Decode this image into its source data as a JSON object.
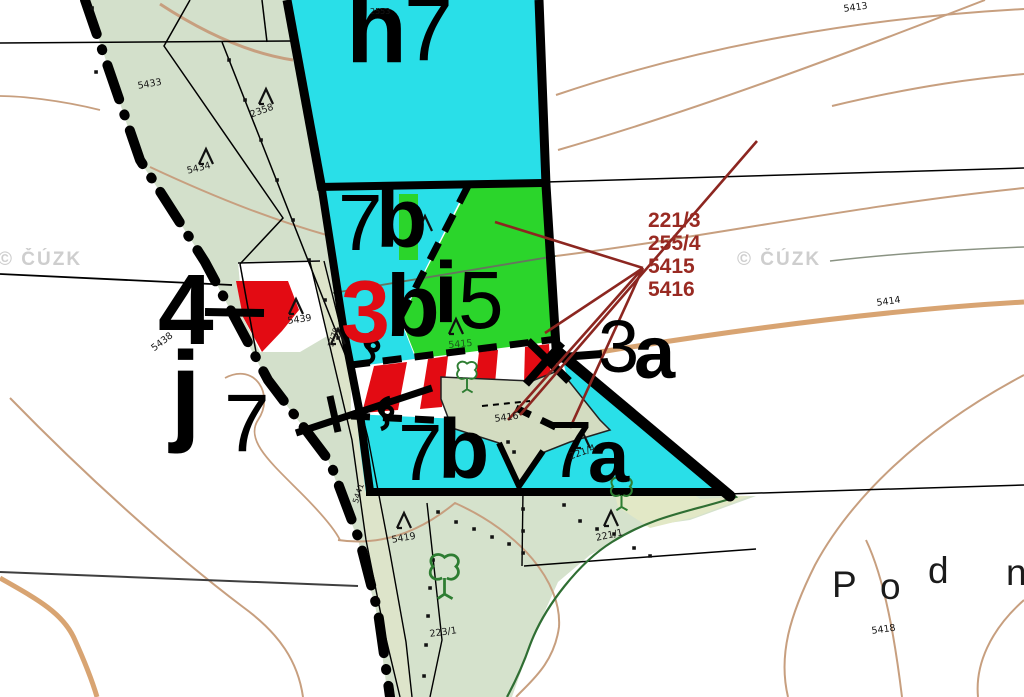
{
  "meta": {
    "width": 1024,
    "height": 697,
    "description": "Cadastral / forestry map detail with parcels, forest stand labels and contour lines"
  },
  "colors": {
    "cyan_parcel": "#29dfe8",
    "green_parcel": "#2bd52b",
    "red_parcel": "#e30b13",
    "sage_area": "#d3e0cb",
    "sage_bottom": "#d5e2cc",
    "sage_yellow": "#e2e8c6",
    "pentagon": "#d3dcc1",
    "strip": "#dde4ca",
    "contour_thin": "#c79f7f",
    "contour_thick": "#d8a472",
    "annotation_red": "#992a22",
    "leader_dark_red": "#8c2620",
    "boundary_black": "#000000",
    "forest_green_line": "#2f6e33",
    "watermark_gray": "#c6c6c6"
  },
  "watermarks": {
    "left": "© ČÚZK",
    "right": "© ČÚZK"
  },
  "place_name": {
    "chars": [
      "P",
      "o",
      "d",
      "n"
    ]
  },
  "stand_labels": [
    {
      "t": "h"
    },
    {
      "t": "7"
    },
    {
      "t": "7"
    },
    {
      "t": "b"
    },
    {
      "t": "3"
    },
    {
      "t": "b"
    },
    {
      "t": "i"
    },
    {
      "t": "5"
    },
    {
      "t": "3"
    },
    {
      "t": "a"
    },
    {
      "t": "7"
    },
    {
      "t": "b"
    },
    {
      "t": "7"
    },
    {
      "t": "a"
    },
    {
      "t": "4"
    },
    {
      "t": "j"
    },
    {
      "t": "7"
    }
  ],
  "annotations": {
    "lines": [
      "221/3",
      "255/4",
      "5415",
      "5416"
    ]
  },
  "parcel_numbers": [
    {
      "t": "2553"
    },
    {
      "t": "5433"
    },
    {
      "t": "5434"
    },
    {
      "t": "2358"
    },
    {
      "t": "5413"
    },
    {
      "t": "5414"
    },
    {
      "t": "5439"
    },
    {
      "t": "5438"
    },
    {
      "t": "1779"
    },
    {
      "t": "5441"
    },
    {
      "t": "5415"
    },
    {
      "t": "5416"
    },
    {
      "t": "5419"
    },
    {
      "t": "223/1"
    },
    {
      "t": "221/1"
    },
    {
      "t": "221/4"
    },
    {
      "t": "5418"
    }
  ],
  "symbols": {
    "conifer_icon": "coniferous-tree map symbol",
    "deciduous_icon": "deciduous-tree map symbol",
    "scrub_icon": "curled scrub map symbol",
    "boundary_dot": "surveyed boundary point"
  }
}
